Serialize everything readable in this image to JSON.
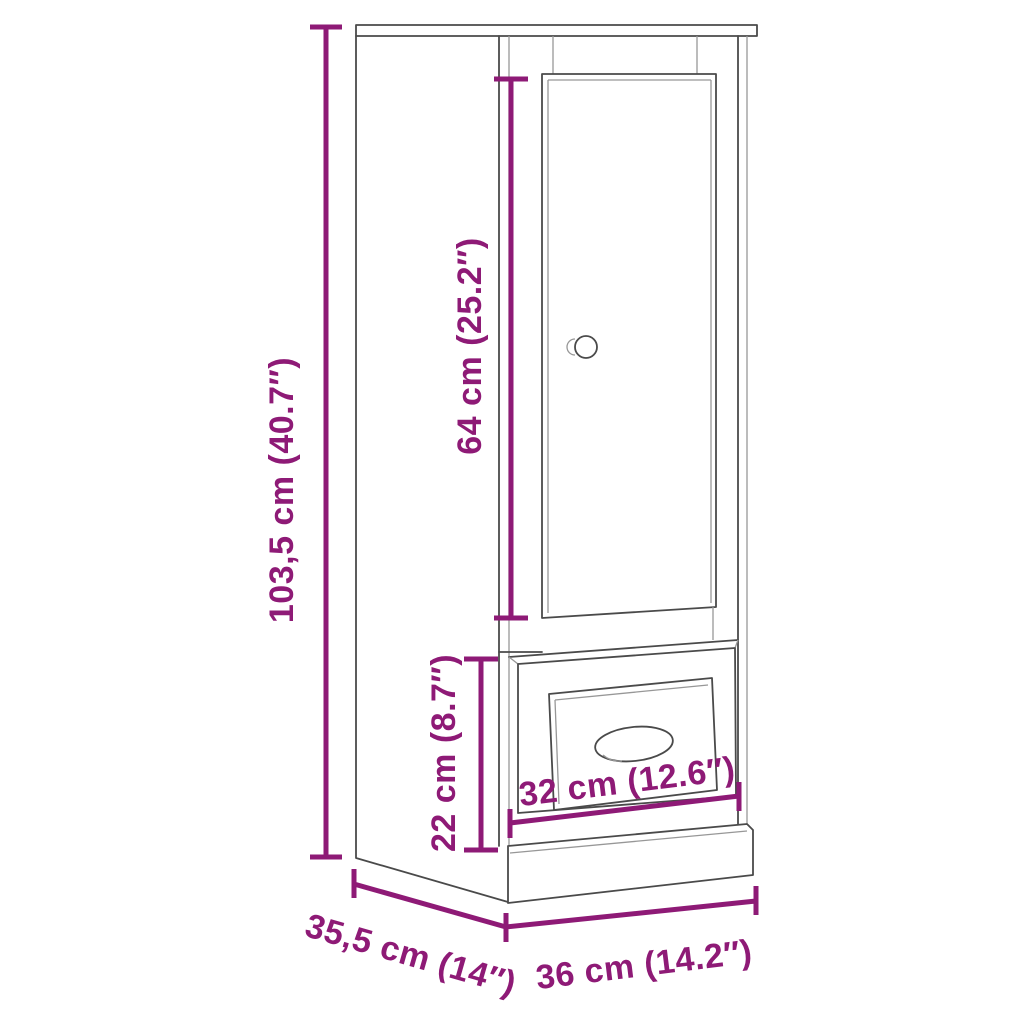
{
  "page": {
    "background": "#FFFFFF"
  },
  "diagram": {
    "type": "product-dimension-diagram",
    "subject": "highboard cabinet with one door and one drawer",
    "style": {
      "accent_color": "#8E1A76",
      "line_color": "#4A4A4A",
      "background": "#FFFFFF"
    },
    "dimensions": {
      "height": {
        "label": "103,5 cm (40.7″)",
        "cm": "103,5",
        "inches": "40.7",
        "orientation": "vertical"
      },
      "door_height": {
        "label": "64 cm (25.2″)",
        "cm": "64",
        "inches": "25.2",
        "orientation": "vertical"
      },
      "drawer_section_height": {
        "label": "22 cm (8.7″)",
        "cm": "22",
        "inches": "8.7",
        "orientation": "vertical"
      },
      "drawer_width": {
        "label": "32 cm (12.6″)",
        "cm": "32",
        "inches": "12.6",
        "orientation": "horizontal"
      },
      "depth": {
        "label": "35,5 cm (14″)",
        "cm": "35,5",
        "inches": "14",
        "orientation": "diagonal"
      },
      "width": {
        "label": "36 cm (14.2″)",
        "cm": "36",
        "inches": "14.2",
        "orientation": "horizontal"
      }
    }
  }
}
